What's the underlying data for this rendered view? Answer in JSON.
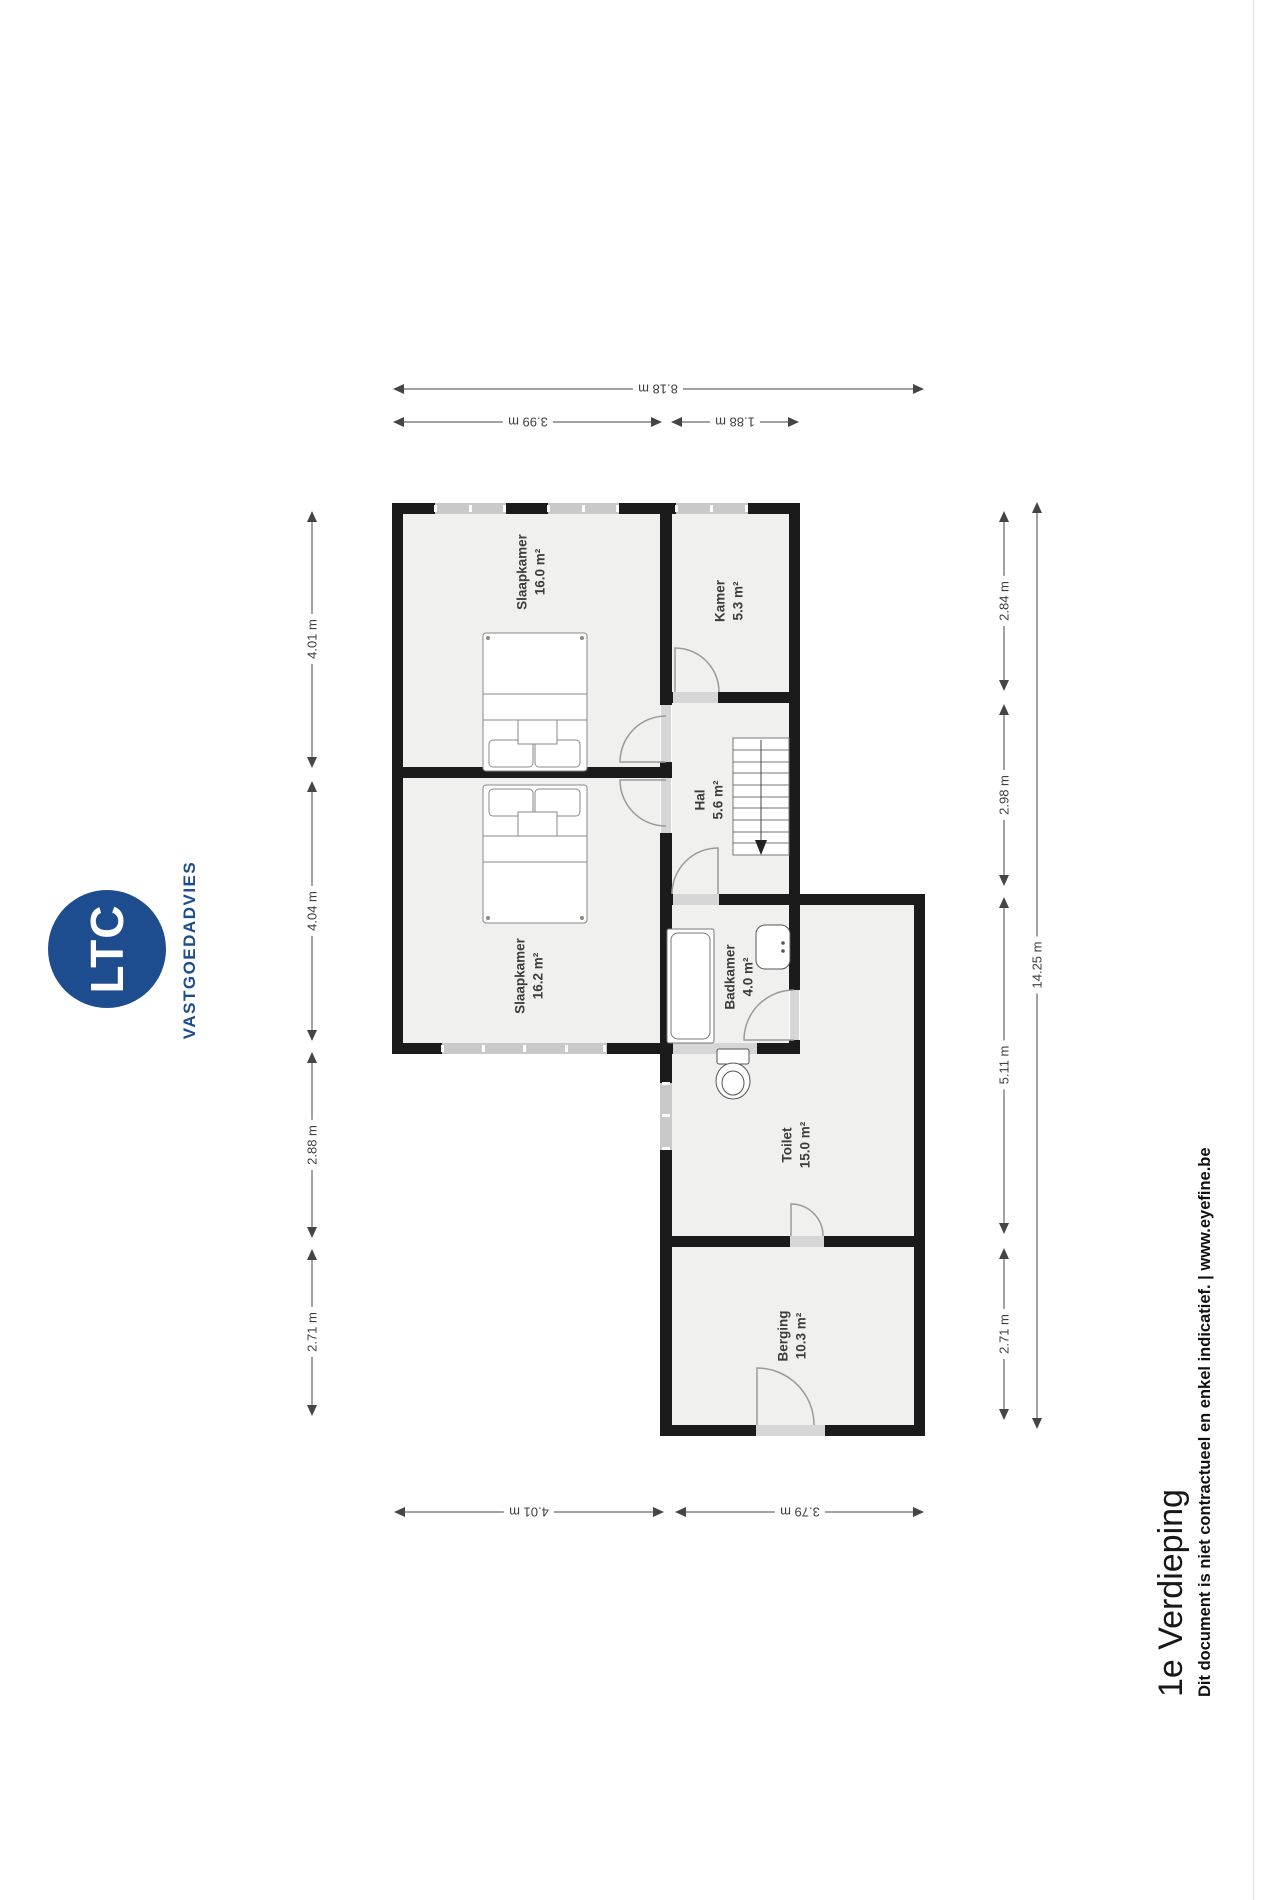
{
  "footer": {
    "title": "1e Verdieping",
    "disclaimer": "Dit document is niet contractueel en enkel indicatief. | www.eyefine.be"
  },
  "logo": {
    "abbr": "LTC",
    "name": "VASTGOEDADVIES",
    "color": "#1d4d8f"
  },
  "rooms": {
    "slaapkamer1": {
      "name": "Slaapkamer",
      "area": "16.0 m²"
    },
    "kamer": {
      "name": "Kamer",
      "area": "5.3 m²"
    },
    "hal": {
      "name": "Hal",
      "area": "5.6 m²"
    },
    "slaapkamer2": {
      "name": "Slaapkamer",
      "area": "16.2 m²"
    },
    "badkamer": {
      "name": "Badkamer",
      "area": "4.0 m²"
    },
    "toilet": {
      "name": "Toilet",
      "area": "15.0 m²"
    },
    "berging": {
      "name": "Berging",
      "area": "10.3 m²"
    }
  },
  "dimensions": {
    "top_total": "8.18 m",
    "top_segments": [
      "3.99 m",
      "1.88 m"
    ],
    "bottom_segments": [
      "4.01 m",
      "3.79 m"
    ],
    "left_segments": [
      "4.01 m",
      "4.04 m",
      "2.88 m",
      "2.71 m"
    ],
    "right_segments": [
      "2.84 m",
      "2.98 m",
      "5.11 m",
      "2.71 m"
    ],
    "right_total": "14.25 m"
  },
  "colors": {
    "wall": "#1b1b1b",
    "room_fill": "#f0f0ef",
    "window": "#c9c9c9",
    "threshold": "#d6d6d6",
    "dimension": "#454545",
    "logo_blue": "#1d4d8f"
  }
}
